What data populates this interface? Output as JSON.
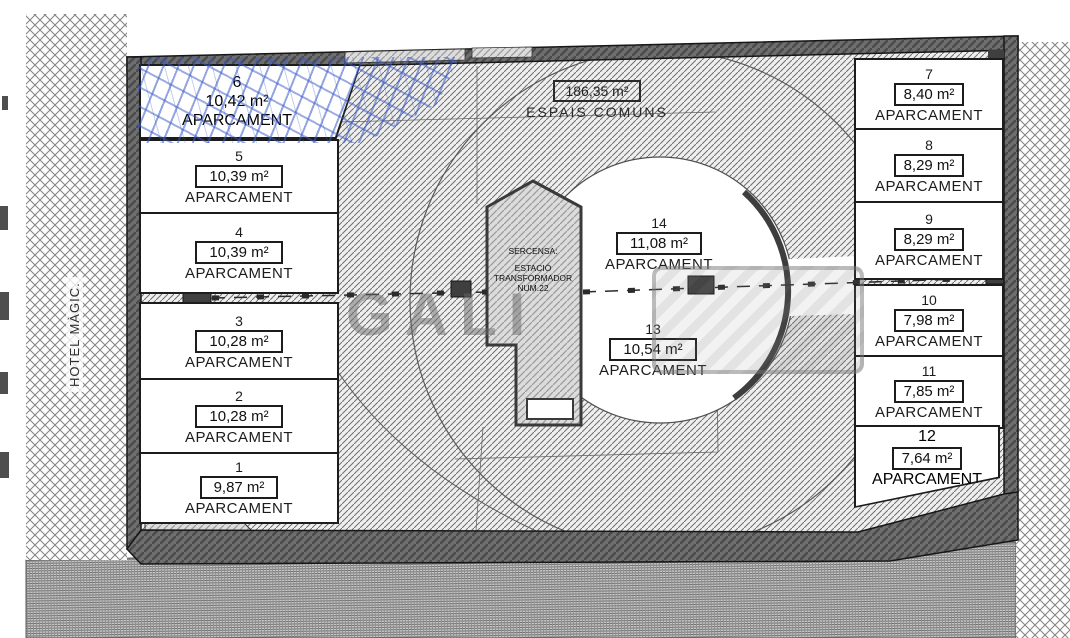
{
  "hotel": {
    "label": "HOTEL MÀGIC."
  },
  "labels": {
    "aparcament": "APARCAMENT"
  },
  "common": {
    "area": "186,35 m²",
    "label": "ESPAIS COMUNS"
  },
  "transformer": {
    "lines": [
      "SERCENSA:",
      "ESTACIÓ",
      "TRANSFORMADOR",
      "NUM.22"
    ]
  },
  "watermark": {
    "text": "GALI"
  },
  "stalls_left": [
    {
      "number": "6",
      "area": "10,42 m²"
    },
    {
      "number": "5",
      "area": "10,39 m²"
    },
    {
      "number": "4",
      "area": "10,39 m²"
    },
    {
      "number": "3",
      "area": "10,28 m²"
    },
    {
      "number": "2",
      "area": "10,28 m²"
    },
    {
      "number": "1",
      "area": "9,87 m²"
    }
  ],
  "stalls_right": [
    {
      "number": "7",
      "area": "8,40 m²"
    },
    {
      "number": "8",
      "area": "8,29 m²"
    },
    {
      "number": "9",
      "area": "8,29 m²"
    },
    {
      "number": "10",
      "area": "7,98 m²"
    },
    {
      "number": "11",
      "area": "7,85 m²"
    },
    {
      "number": "12",
      "area": "7,64 m²"
    }
  ],
  "stalls_center": [
    {
      "number": "14",
      "area": "11,08 m²"
    },
    {
      "number": "13",
      "area": "10,54 m²"
    }
  ],
  "colors": {
    "annotation_blue": "#3a5bc7",
    "wall_gray": "#6b6b6b"
  }
}
